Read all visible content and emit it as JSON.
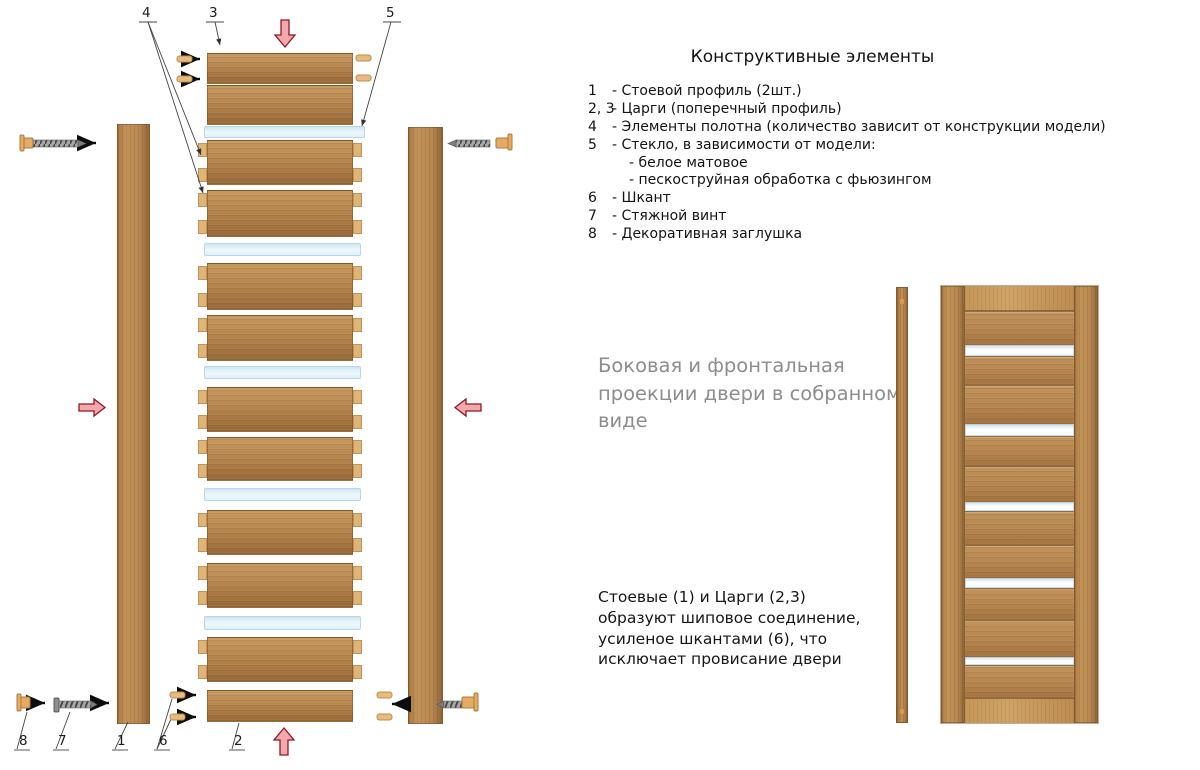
{
  "legend": {
    "title": "Конструктивные  элементы",
    "items": [
      {
        "num": "1",
        "text": "- Стоевой профиль (2шт.)"
      },
      {
        "num": "2, 3",
        "text": "- Царги (поперечный профиль)"
      },
      {
        "num": "4",
        "text": "- Элементы полотна (количество зависит от конструкции модели)"
      },
      {
        "num": "5",
        "text": "- Стекло, в зависимости от модели:"
      },
      {
        "num": "",
        "text": "- белое матовое"
      },
      {
        "num": "",
        "text": "- пескоструйная обработка с фьюзингом"
      },
      {
        "num": "6",
        "text": "- Шкант"
      },
      {
        "num": "7",
        "text": "- Стяжной винт"
      },
      {
        "num": "8",
        "text": "- Декоративная заглушка"
      }
    ]
  },
  "captions": {
    "assembled_view_lines": [
      "Боковая и фронтальная",
      "проекции двери в собранном",
      "виде"
    ],
    "joint_note_lines": [
      "Стоевые (1) и Царги (2,3)",
      "образуют шиповое соединение,",
      "усиленое шкантами (6), что",
      "исключает провисание двери"
    ]
  },
  "callouts": {
    "top": [
      "4",
      "3",
      "5"
    ],
    "bottom": [
      "8",
      "7",
      "1",
      "6",
      "2"
    ]
  },
  "colors": {
    "wood": "#b98a52",
    "wood_light": "#e0b376",
    "glass": "#dceef8",
    "red_arrow_fill": "#f4a7ad",
    "red_arrow_stroke": "#8e1b22",
    "caption_gray": "#8d8d8d",
    "text_black": "#161616"
  }
}
